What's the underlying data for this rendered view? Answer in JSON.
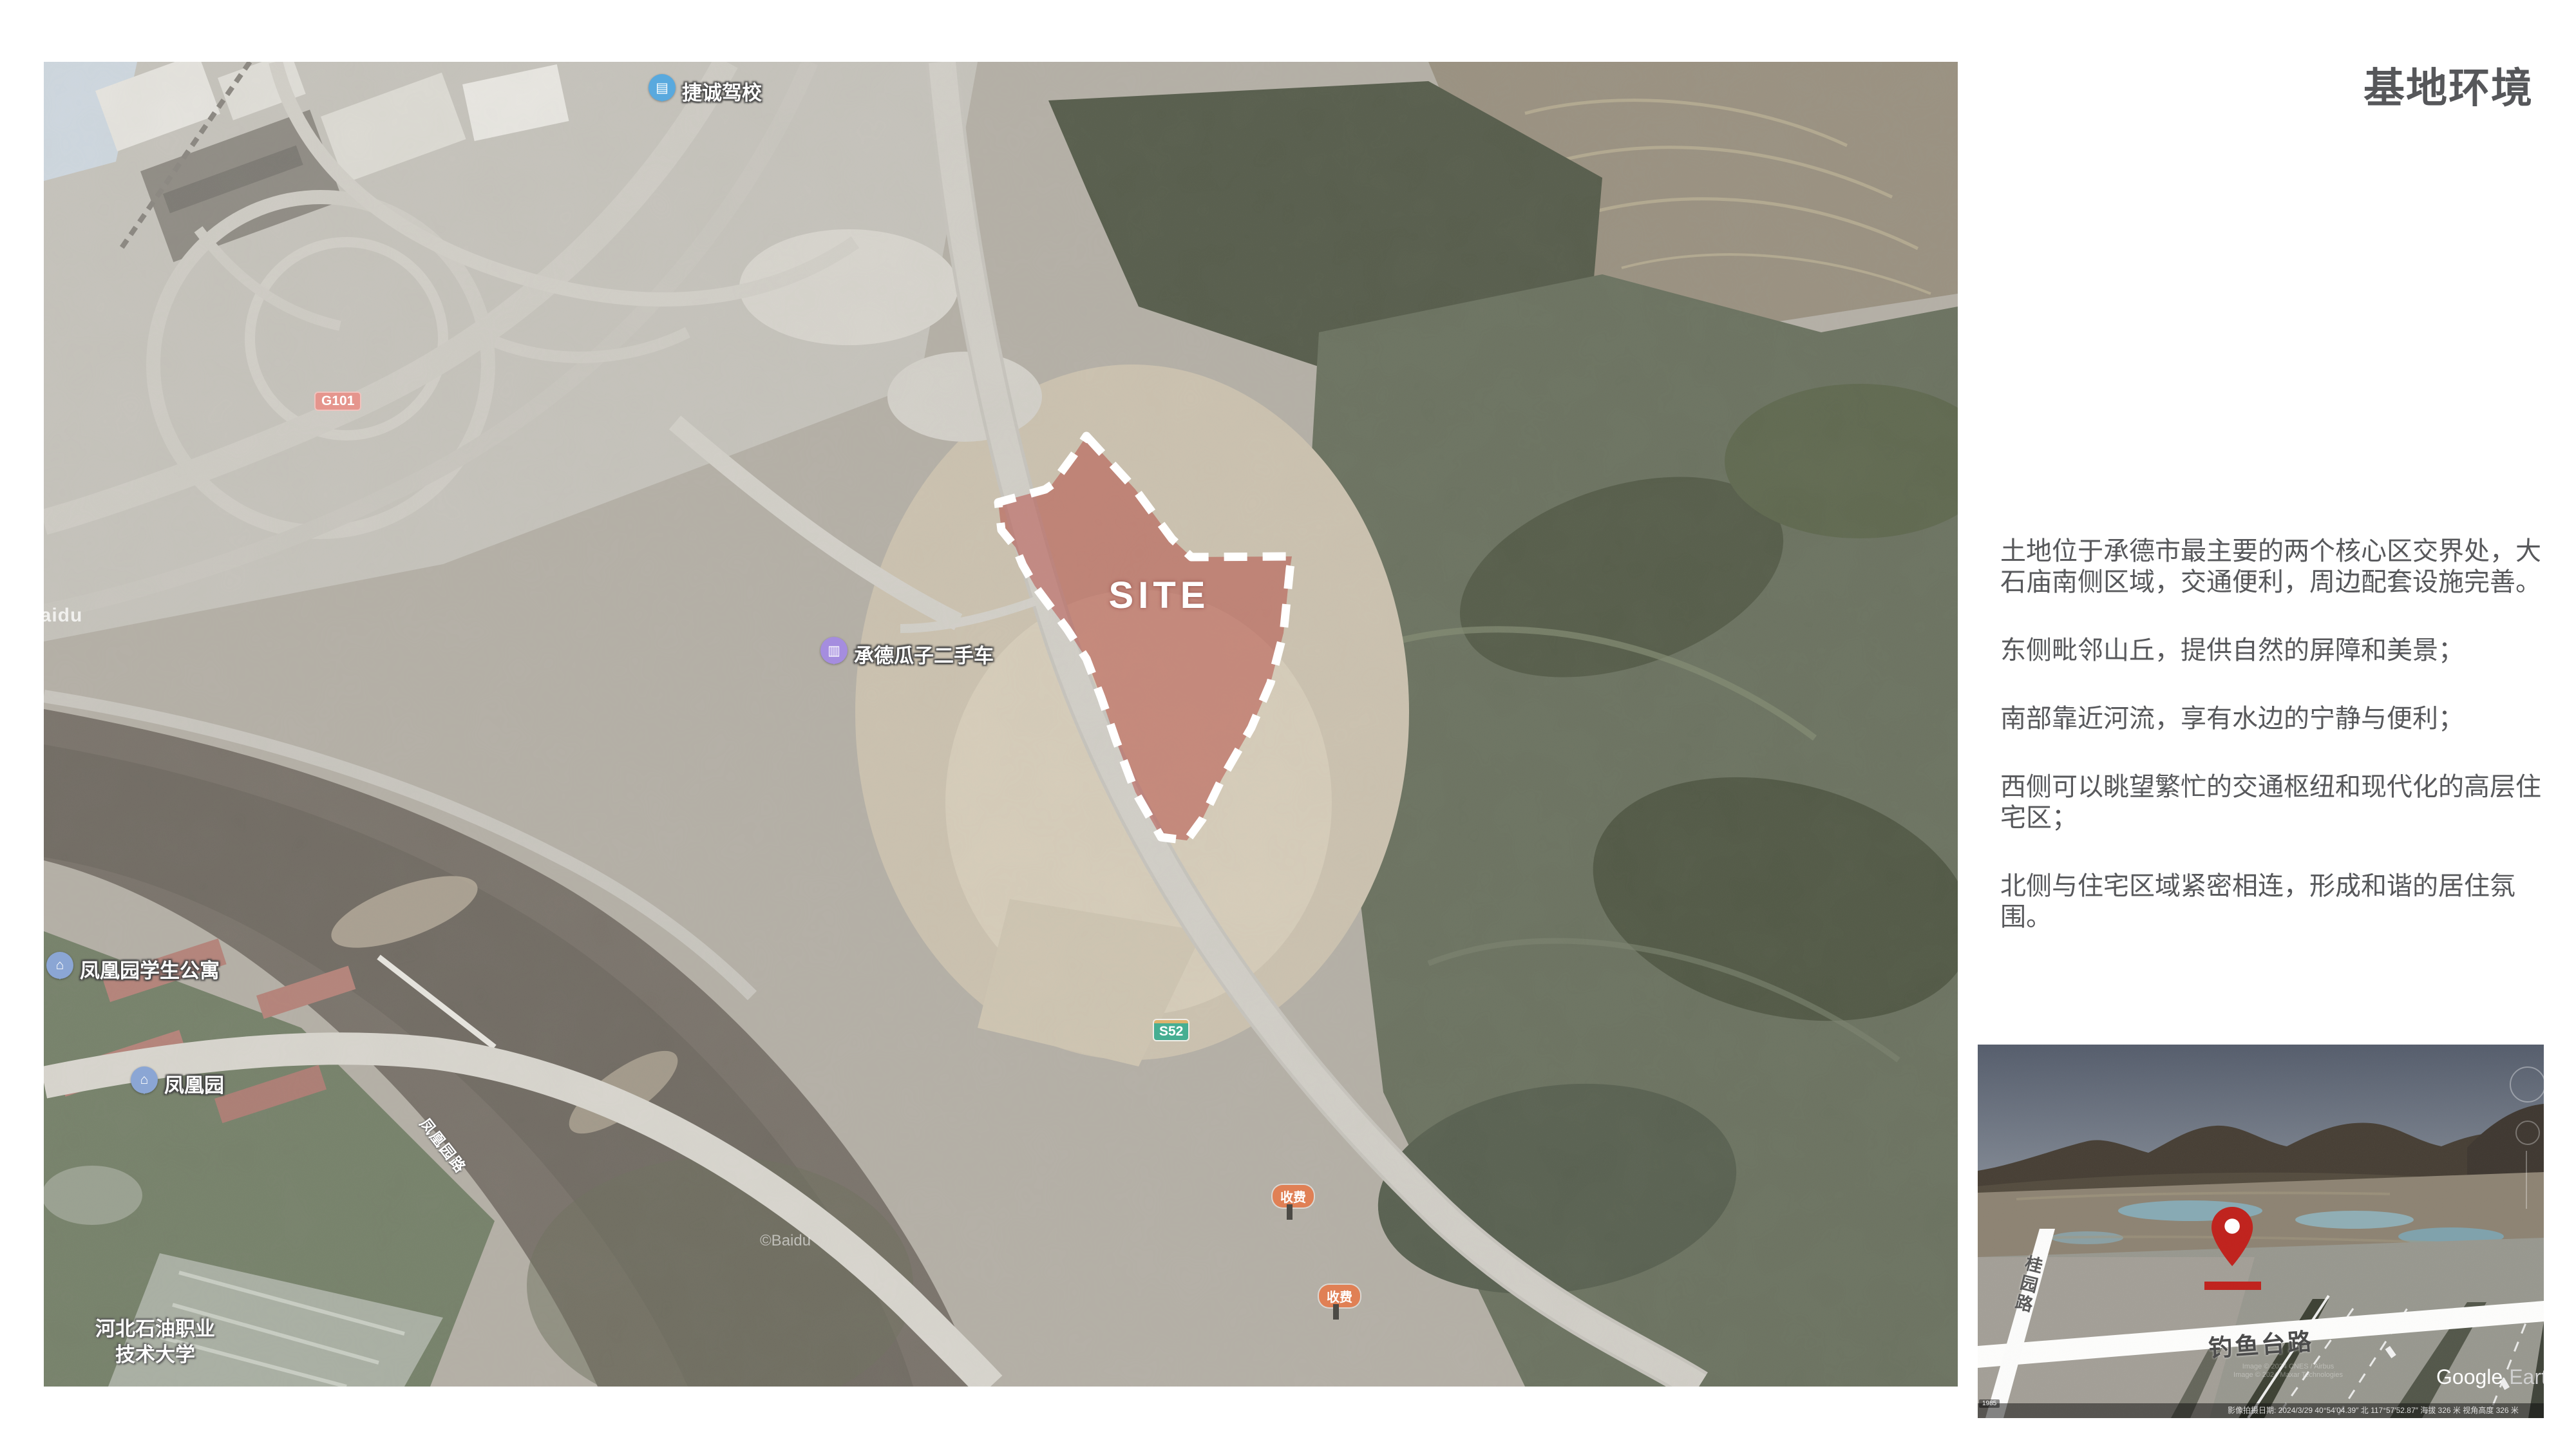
{
  "title": "基地环境",
  "description": {
    "paragraphs": [
      "土地位于承德市最主要的两个核心区交界处，大石庙南侧区域，交通便利，周边配套设施完善。",
      "东侧毗邻山丘，提供自然的屏障和美景；",
      "南部靠近河流，享有水边的宁静与便利；",
      "西侧可以眺望繁忙的交通枢纽和现代化的高层住宅区；",
      "北侧与住宅区域紧密相连，形成和谐的居住氛围。"
    ]
  },
  "map": {
    "site_label": "SITE",
    "poi": {
      "driving_school": "捷诚驾校",
      "used_car_dealer": "承德瓜子二手车",
      "student_apartment": "凤凰园学生公寓",
      "phoenix_garden": "凤凰园",
      "university_line1": "河北石油职业",
      "university_line2": "技术大学",
      "road_label": "凤凰园路"
    },
    "badges": {
      "national_road": "G101",
      "provincial_road": "S52",
      "toll_1": "收费",
      "toll_2": "收费"
    },
    "watermark_left": "Baidu",
    "watermark_bottom": "©Baidu"
  },
  "inset": {
    "road_horizontal": "钓鱼台路",
    "road_vertical": "桂园路",
    "google": "Google",
    "earth": "Earth",
    "year_chip": "1985",
    "credits_1": "Image © 2024 CNES / Airbus",
    "credits_2": "Image © 2024 Maxar Technologies",
    "status_bar": "影像拍摄日期: 2024/3/29    40°54′04.39″ 北 117°57′52.87″    海拔 326 米    视角高度 326 米"
  },
  "colors": {
    "site_fill": "#b23a34",
    "pin_red": "#c0211c",
    "title_gray": "#56575a"
  }
}
